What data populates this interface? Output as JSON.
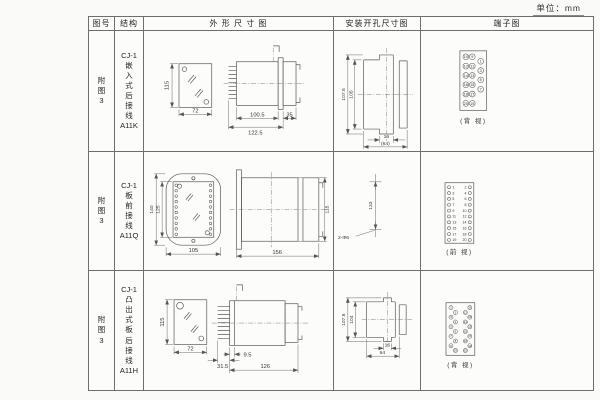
{
  "unit_label": "单位：mm",
  "table": {
    "headers": {
      "fig": "图号",
      "struct": "结构",
      "outline": "外 形 尺 寸 图",
      "mount": "安装开孔尺寸图",
      "terminal": "端子图"
    }
  },
  "rows": [
    {
      "fig": "附\n图\n3",
      "struct": "CJ-1\n嵌\n入\n式\n后\n接\n线\nA11K",
      "outline": {
        "h": "115",
        "w": "72",
        "body_len": "100.5",
        "total_len": "122.5",
        "rear_len": "35"
      },
      "mount": {
        "outer": "107.5",
        "inner": "105",
        "slot": "16",
        "span": "(64)"
      },
      "terminal": {
        "caption": "(背 视)",
        "col_a": [
          "10",
          "12",
          "14",
          "16",
          "18",
          "20"
        ],
        "col_b": [
          "9",
          "11",
          "13",
          "15",
          "17",
          "19"
        ],
        "col_c": [
          "1",
          "3",
          "5",
          "7"
        ]
      }
    },
    {
      "fig": "附\n图\n3",
      "struct": "CJ-1\n板\n前\n接\n线\nA11Q",
      "outline": {
        "outer_h": "140",
        "inner_h": "125",
        "w": "105",
        "len": "156",
        "side_h": "115"
      },
      "mount": {
        "pitch": "133",
        "hole_note": "2-Φ6"
      },
      "terminal": {
        "caption": "(前 视)",
        "left": [
          "1",
          "3",
          "5",
          "7",
          "9",
          "11",
          "13",
          "15",
          "17",
          "19"
        ],
        "right": [
          "2",
          "4",
          "6",
          "8",
          "10",
          "12",
          "14",
          "16",
          "18",
          "20"
        ]
      }
    },
    {
      "fig": "附\n图\n3",
      "struct": "CJ-1\n凸\n出\n式\n板\n后\n接\n线\nA11H",
      "outline": {
        "h": "115",
        "w": "72",
        "blade_len": "31.5",
        "panel_gap": "9.5",
        "total_len": "126"
      },
      "mount": {
        "outer": "107.5",
        "inner": "104",
        "slot": "16",
        "span": "64"
      },
      "terminal": {
        "caption": "(背 视)",
        "left": [
          "1",
          "2",
          "3",
          "4",
          "5",
          "6",
          "7",
          "8",
          "9",
          "10"
        ],
        "right": [
          "11",
          "12",
          "13",
          "14",
          "15",
          "16",
          "17",
          "18",
          "19",
          "20"
        ]
      }
    }
  ]
}
